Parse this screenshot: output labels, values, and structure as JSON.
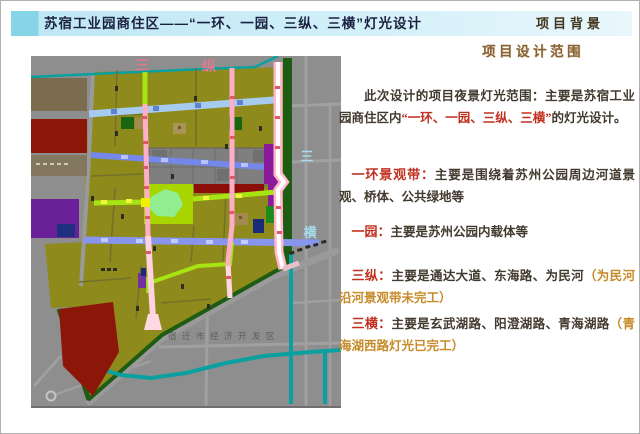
{
  "header": {
    "title": "苏宿工业园商住区——“一环、一园、三纵、三横”灯光设计",
    "corner": "项目背景"
  },
  "panel": {
    "heading": "项目设计范围",
    "intro_1": "此次设计的项目夜景灯光范围：主要是苏宿工业园商住区内",
    "intro_2": "“一环、一园、三纵、三横”",
    "intro_3": "的灯光设计。",
    "items": [
      {
        "label": "一环景观带：",
        "body": "主要是围绕着苏州公园周边河道景观、桥体、公共绿地等",
        "note": ""
      },
      {
        "label": "一园：",
        "body": "主要是苏州公园内载体等",
        "note": ""
      },
      {
        "label": "三纵：",
        "body": "主要是通达大道、东海路、为民河",
        "note": "（为民河沿河景观带未完工）"
      },
      {
        "label": "三横：",
        "body": "主要是玄武湖路、阳澄湖路、青海湖路",
        "note": "（青海湖西路灯光已完工）"
      }
    ]
  },
  "map": {
    "label_v1": "三",
    "label_v2": "纵",
    "label_h1": "三",
    "label_h2": "横",
    "district": "宿迁市经济开发区"
  },
  "colors": {
    "red": "#c03020",
    "gold": "#c78a28",
    "gold-dark": "#8a6134",
    "body": "#423a2e",
    "navy": "#1b2140"
  }
}
